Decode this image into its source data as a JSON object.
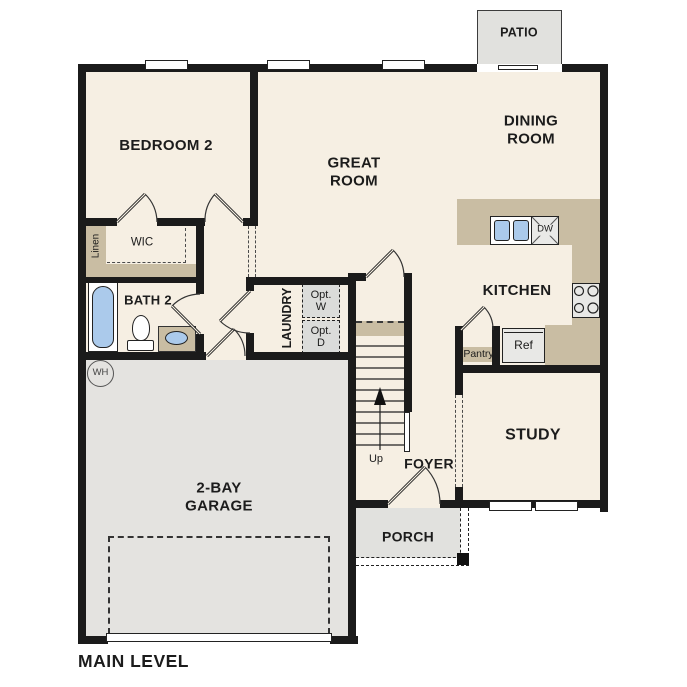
{
  "plan": {
    "title": "MAIN LEVEL"
  },
  "rooms": {
    "bedroom2": "BEDROOM 2",
    "great_room": "GREAT\nROOM",
    "dining_room": "DINING\nROOM",
    "kitchen": "KITCHEN",
    "study": "STUDY",
    "foyer": "FOYER",
    "bath2": "BATH 2",
    "laundry": "LAUNDRY",
    "wic": "WIC",
    "linen": "Linen",
    "garage": "2-BAY\nGARAGE"
  },
  "outdoor": {
    "patio": "PATIO",
    "porch": "PORCH"
  },
  "fixtures": {
    "washer_opt": "Opt.\nW",
    "dryer_opt": "Opt.\nD",
    "pantry": "Pantry",
    "refrigerator": "Ref",
    "dishwasher": "DW",
    "water_heater": "WH",
    "stairs_direction": "Up"
  },
  "colors": {
    "floor": "#f6efe3",
    "garage_floor": "#e4e3e0",
    "outdoor_concrete": "#e1e1de",
    "counter_tan": "#c9bda3",
    "wall_black": "#1b1b1b",
    "plumbing_blue": "#abcaeb",
    "appliance_gray": "#e8e8e6"
  },
  "fixture_icons": [
    "bathtub-icon",
    "toilet-icon",
    "vanity-sink-icon",
    "kitchen-sink-icon",
    "stove-burners-icon",
    "up-arrow-icon",
    "door-swing-arc",
    "window-glyph",
    "sliding-door-glyph",
    "garage-door-dashed-outline",
    "water-heater-icon"
  ]
}
